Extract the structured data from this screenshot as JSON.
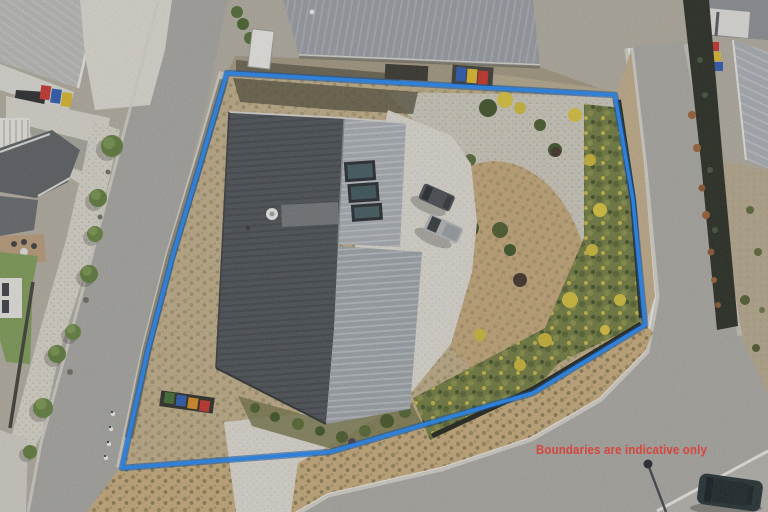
{
  "image": {
    "kind": "aerial-drone-photo",
    "description": "Top-down aerial photo of a corner residential lot with a dark corrugated-roof house, concrete driveway, gravel and scrub landscaping, bordered by roads, with a blue property boundary overlay."
  },
  "overlay": {
    "disclaimer": "Boundaries are indicative only",
    "disclaimer_color": "#d8453c",
    "boundary": {
      "color": "#2f80d9",
      "shadow_color": "#17549e"
    }
  },
  "palette": {
    "canvas": "#b0ab9e",
    "road": "#a5a4a0",
    "road_right": "#a9a7a2",
    "concrete": "#dcd9d0",
    "curb": "#efede8",
    "lot_grass": "#bfac87",
    "verge_grass": "#c6a97a",
    "gravel": "#cbc7ba",
    "dry_lawn": "#c2a577",
    "scrub_green": "#6f7a3e",
    "hedge_dark": "#252a20",
    "roof_dark": "#4b5055",
    "roof_light": "#a6abb1",
    "roof_lower": "#9ba1a7",
    "roof_neighbor": "#979ba2",
    "roof_topleft": "#b8b9b5",
    "roof_right": "#a9adb2",
    "car_gray": "#474c51",
    "car_silver": "#b3b6b9",
    "car_dark_teal": "#232f33",
    "lamp_shadow": "#3f4145"
  },
  "objects": {
    "skylight_count": 3,
    "cars_on_driveway": 2,
    "bins_top": [
      {
        "color": "#2b57b2"
      },
      {
        "color": "#ddb92a"
      },
      {
        "color": "#c53129"
      }
    ],
    "bins_topleft": [
      {
        "color": "#c5322b"
      },
      {
        "color": "#2a57b0"
      },
      {
        "color": "#d8b428"
      }
    ],
    "bins_house": [
      {
        "color": "#3f6a2f"
      },
      {
        "color": "#2b57ad"
      },
      {
        "color": "#d88a20"
      },
      {
        "color": "#c23127"
      }
    ],
    "bins_right": [
      {
        "color": "#c53129"
      },
      {
        "color": "#dcb92a"
      },
      {
        "color": "#2b57b2"
      }
    ]
  }
}
